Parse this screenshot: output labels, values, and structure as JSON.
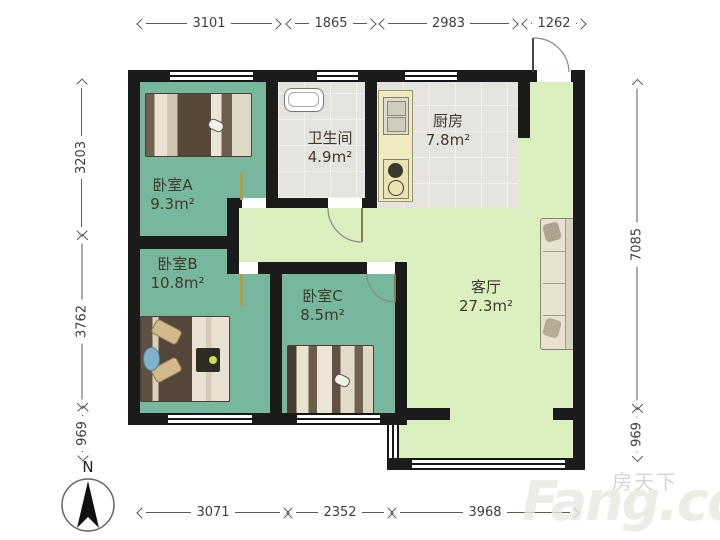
{
  "dims": {
    "top": [
      "3101",
      "1865",
      "2983",
      "1262"
    ],
    "left": [
      "3203",
      "3762",
      "969"
    ],
    "right": [
      "7085",
      "969"
    ],
    "bottom": [
      "3071",
      "2352",
      "3968"
    ]
  },
  "rooms": {
    "bedroom_a": {
      "name": "卧室A",
      "area": "9.3m²"
    },
    "bedroom_b": {
      "name": "卧室B",
      "area": "10.8m²"
    },
    "bedroom_c": {
      "name": "卧室C",
      "area": "8.5m²"
    },
    "bathroom": {
      "name": "卫生间",
      "area": "4.9m²"
    },
    "kitchen": {
      "name": "厨房",
      "area": "7.8m²"
    },
    "living_room": {
      "name": "客厅",
      "area": "27.3m²"
    }
  },
  "compass": {
    "label": "N"
  },
  "watermark": {
    "brand": "房天下",
    "site": "Fang.com"
  },
  "colors": {
    "bedroom_fill": "#77b79e",
    "living_fill": "#dcefbf",
    "service_fill": "#e5e3de",
    "wall": "#1b1b1b"
  }
}
